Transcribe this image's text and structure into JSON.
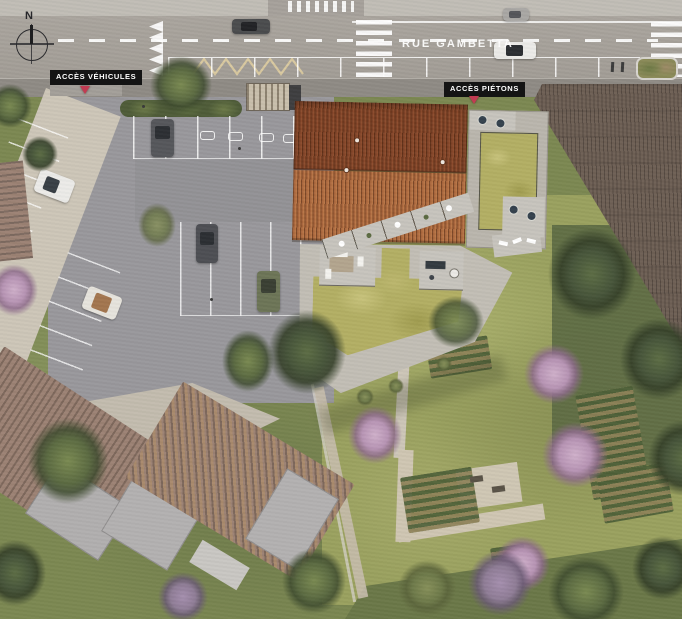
{
  "title": "Aerial site plan render",
  "compass": {
    "label": "N"
  },
  "street": {
    "name": "RUE GAMBETTA"
  },
  "access": {
    "vehicles_label": "ACCÈS VÉHICULES",
    "pedestrians_label": "ACCÈS PIÉTONS"
  },
  "objects": {
    "street_cars": [
      "white-sedan-driving",
      "dark-car-driving",
      "gray-car-parked"
    ],
    "parking_cars": [
      "dark-gray-vertical",
      "dark-gray-vertical",
      "olive-green-vertical",
      "white-horizontal",
      "white-tan-roof",
      "black-horizontal"
    ],
    "road_markings": [
      "center-dashed-line",
      "zebra-crosswalk-west",
      "zebra-crosswalk-east",
      "chevron-strip",
      "zigzag-bus-marking",
      "parking-bay-lines",
      "car-share-symbols"
    ],
    "site_features": [
      "pitched-terracotta-roof",
      "sedum-green-roofs",
      "roof-terraces",
      "hedge-strip",
      "bike-shelter",
      "vegetable-beds",
      "garden-paths",
      "picnic-area",
      "neighbor-houses",
      "flowering-trees"
    ]
  },
  "colors": {
    "road": "#a6a19b",
    "sidewalk_north": "#c1bdb6",
    "sidewalk_south": "#8f8b85",
    "parking": "#99989c",
    "path_light": "#cdc6b8",
    "roof_tile_dark": "#7d4227",
    "roof_tile_light": "#a9663c",
    "sedum_green": "#b3af64",
    "paver": "#c7c4bd",
    "frame_gray": "#bab6ad",
    "garden_green": "#9aa15f",
    "lawn_green": "#7c8852",
    "neighbor_green": "#6b7848",
    "hedge_green": "#4f5c38",
    "neighbor_roof": "#6e6055",
    "house_roof": "#9c8274",
    "house_flat": "#b1afaf",
    "label_bg": "#141414",
    "label_text": "#ffffff",
    "marker_red": "#c23b52",
    "zigzag_tan": "#d9c9a0",
    "car_white": "#ecebe8",
    "car_dark": "#4b4c4e",
    "car_black": "#2e2e30",
    "car_olive": "#6d7557"
  }
}
